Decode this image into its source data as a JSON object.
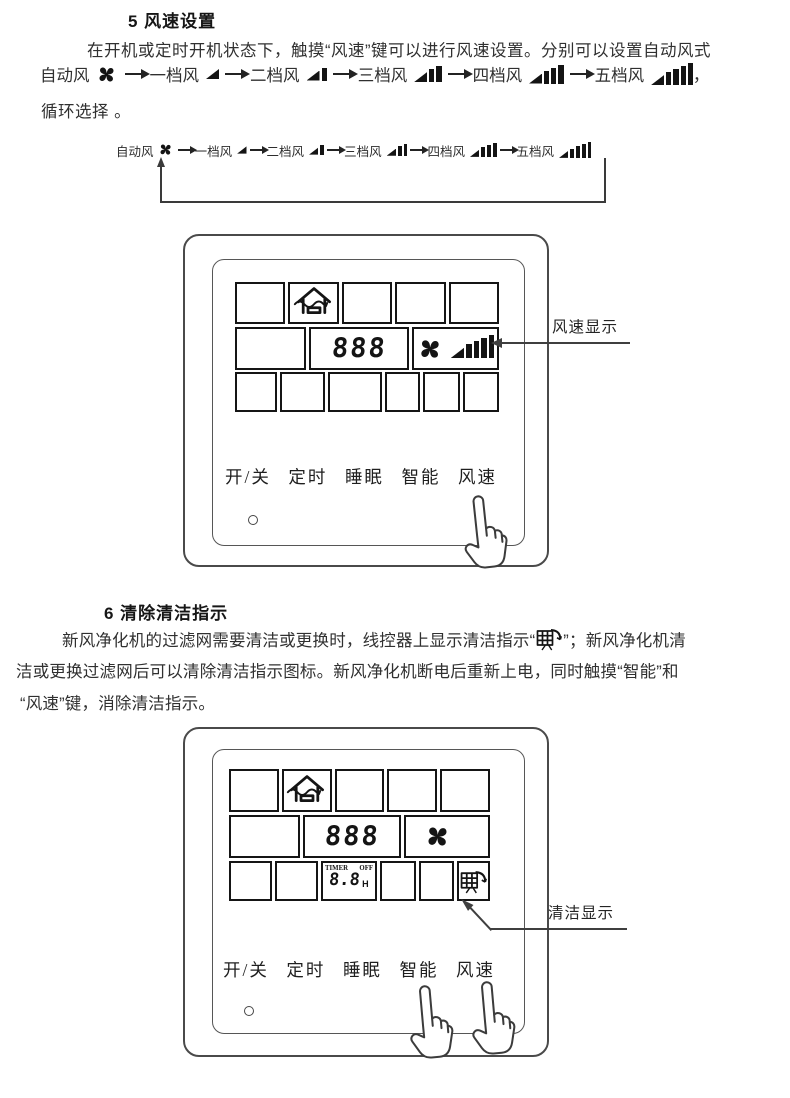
{
  "colors": {
    "ink": "#2f2f2f",
    "diagram_line": "#3a3a3a",
    "lcd_border": "#151515"
  },
  "section5": {
    "heading": "5 风速设置",
    "para_line1": "在开机或定时开机状态下，触摸“风速”键可以进行风速设置。分别可以设置自动风式",
    "trailing_comma": "，",
    "para_line3": "循环选择 。"
  },
  "speeds": [
    {
      "label": "自动风",
      "type": "fan",
      "bars": 0
    },
    {
      "label": "一档风",
      "type": "bars",
      "bars": 1
    },
    {
      "label": "二档风",
      "type": "bars",
      "bars": 2
    },
    {
      "label": "三档风",
      "type": "bars",
      "bars": 3
    },
    {
      "label": "四档风",
      "type": "bars",
      "bars": 4
    },
    {
      "label": "五档风",
      "type": "bars",
      "bars": 5
    }
  ],
  "panel1": {
    "display_digits": "888",
    "fan_speed_bars": 5,
    "buttons": [
      "开/关",
      "定时",
      "睡眠",
      "智能",
      "风速"
    ],
    "callout": "风速显示"
  },
  "section6": {
    "heading": "6 清除清洁指示",
    "line1_pre": "新风净化机的过滤网需要清洁或更换时，线控器上显示清洁指示“",
    "line1_post": "”；新风净化机清",
    "line2": "洁或更换过滤网后可以清除清洁指示图标。新风净化机断电后重新上电，同时触摸“智能”和",
    "line3": "“风速”键，消除清洁指示。"
  },
  "panel2": {
    "display_digits": "888",
    "timer_label": "TIMER",
    "off_label": "OFF",
    "timer_digits": "8.8",
    "timer_unit": "H",
    "buttons": [
      "开/关",
      "定时",
      "睡眠",
      "智能",
      "风速"
    ],
    "callout": "清洁显示"
  }
}
